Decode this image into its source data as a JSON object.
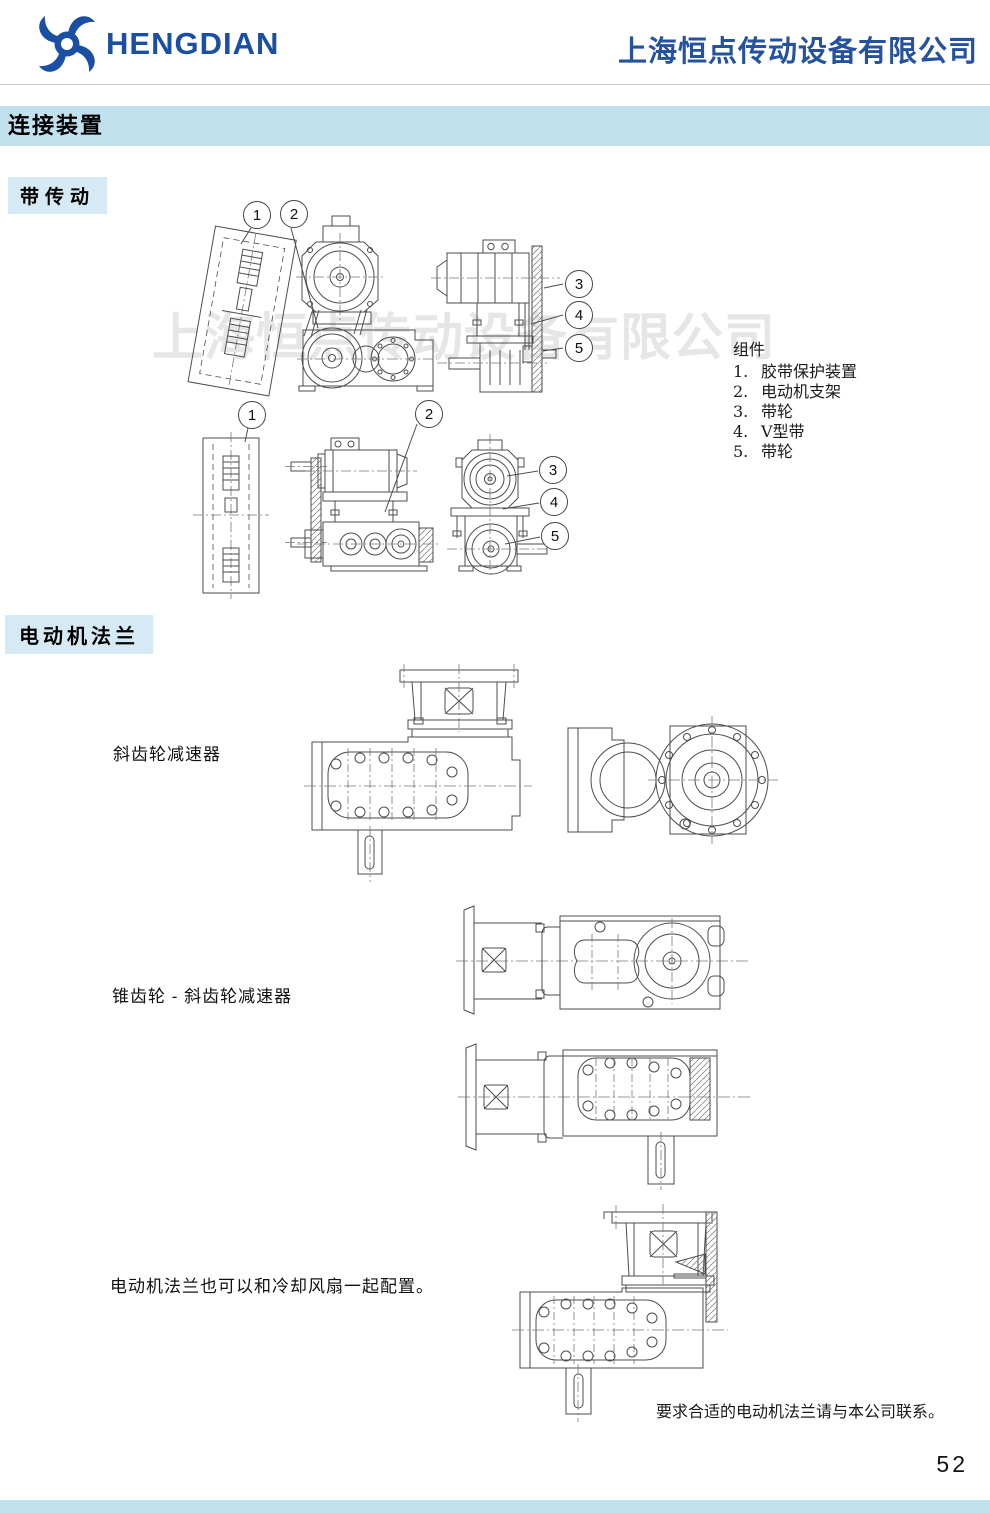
{
  "header": {
    "logo_text": "HENGDIAN",
    "company_name": "上海恒点传动设备有限公司"
  },
  "watermark": "上海恒点传动设备有限公司",
  "section_title": "连接装置",
  "belt_drive": {
    "heading": "带传动",
    "callouts": {
      "row1": [
        "1",
        "2",
        "3",
        "4",
        "5"
      ],
      "row2": [
        "1",
        "2",
        "3",
        "4",
        "5"
      ]
    },
    "parts_list": {
      "title": "组件",
      "items": [
        {
          "num": "1.",
          "label": "胶带保护装置"
        },
        {
          "num": "2.",
          "label": "电动机支架"
        },
        {
          "num": "3.",
          "label": "带轮"
        },
        {
          "num": "4.",
          "label": "V型带"
        },
        {
          "num": "5.",
          "label": "带轮"
        }
      ]
    }
  },
  "motor_flange": {
    "heading": "电动机法兰",
    "label_helical": "斜齿轮减速器",
    "label_bevel": "锥齿轮 - 斜齿轮减速器",
    "label_fan": "电动机法兰也可以和冷却风扇一起配置。",
    "contact_note": "要求合适的电动机法兰请与本公司联系。"
  },
  "page_number": "52",
  "colors": {
    "brand_blue": "#1b4fa3",
    "company_blue": "#24529f",
    "section_bar_blue": "#c2e1ef",
    "chip_blue": "#d6eaf5",
    "drawing_stroke": "#4d4d4d",
    "watermark_gray": "#e6e6e6"
  }
}
